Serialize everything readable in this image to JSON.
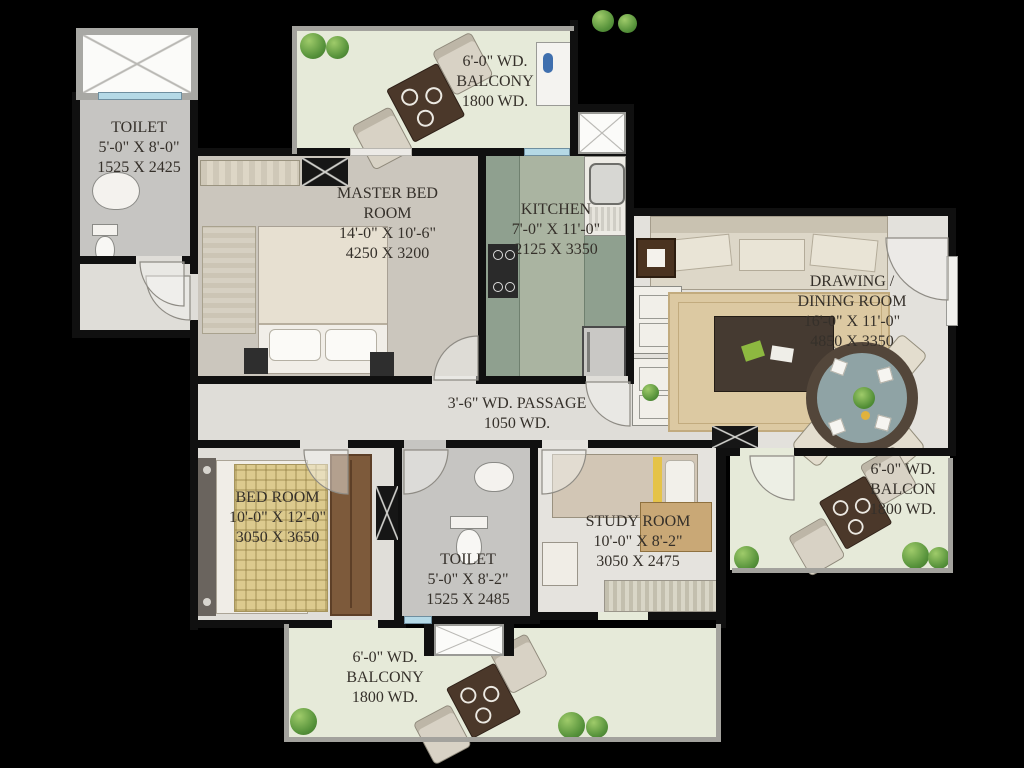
{
  "palette": {
    "background": "#000000",
    "wall": "#101010",
    "floor_light": "#e3e1dc",
    "floor_master": "#cbc6bd",
    "floor_toilet": "#c6c5c2",
    "balcony_floor": "#e6ead9",
    "kitchen_counter": "#8fa08f",
    "kitchen_floor": "#aab4a1",
    "label_text": "#35302a",
    "window_glass": "#b5d9e6",
    "shrub_green": "#55913a",
    "wood_brown": "#7d5a3b"
  },
  "rooms": {
    "toilet_top": {
      "name": "TOILET",
      "size_ft": "5'-0\" X 8'-0\"",
      "size_mm": "1525 X 2425"
    },
    "balcony_top": {
      "width_ft": "6'-0\" WD.",
      "name": "BALCONY",
      "width_mm": "1800 WD."
    },
    "master_bedroom": {
      "name": "MASTER BED ROOM",
      "size_ft": "14'-0\" X 10'-6\"",
      "size_mm": "4250 X 3200"
    },
    "kitchen": {
      "name": "KITCHEN",
      "size_ft": "7'-0\" X 11'-0\"",
      "size_mm": "2125 X 3350"
    },
    "drawing_dining": {
      "name": "DRAWING / DINING ROOM",
      "size_ft": "16'-0\" X 11'-0\"",
      "size_mm": "4850 X 3350"
    },
    "passage": {
      "name": "3'-6\" WD. PASSAGE",
      "width_mm": "1050 WD."
    },
    "bedroom": {
      "name": "BED ROOM",
      "size_ft": "10'-0\" X 12'-0\"",
      "size_mm": "3050 X 3650"
    },
    "toilet_bottom": {
      "name": "TOILET",
      "size_ft": "5'-0\" X 8'-2\"",
      "size_mm": "1525 X 2485"
    },
    "study_room": {
      "name": "STUDY ROOM",
      "size_ft": "10'-0\" X 8'-2\"",
      "size_mm": "3050 X 2475"
    },
    "balcony_right": {
      "width_ft": "6'-0\" WD.",
      "name": "BALCON",
      "width_mm": "1800 WD."
    },
    "balcony_bottom": {
      "width_ft": "6'-0\" WD.",
      "name": "BALCONY",
      "width_mm": "1800 WD."
    }
  }
}
